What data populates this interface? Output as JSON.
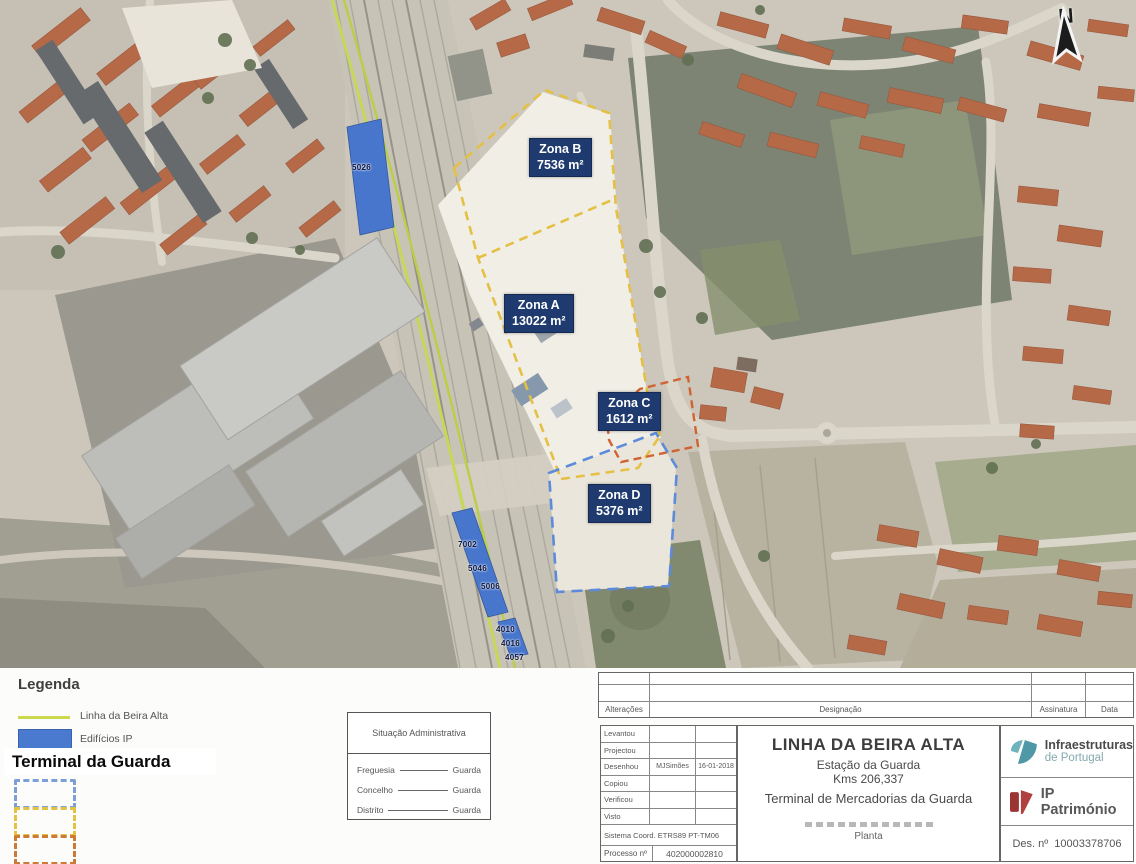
{
  "map": {
    "north_label": "N",
    "zones": [
      {
        "name": "Zona B",
        "area": "7536 m²"
      },
      {
        "name": "Zona A",
        "area": "13022 m²"
      },
      {
        "name": "Zona C",
        "area": "1612 m²"
      },
      {
        "name": "Zona D",
        "area": "5376 m²"
      }
    ],
    "building_labels": [
      "5026",
      "7002",
      "5046",
      "5006",
      "4010",
      "4016",
      "4057"
    ],
    "colors": {
      "zone_label_bg": "#1e3a6e",
      "zones_ab_outline": "#e3bd3a",
      "zone_c_outline": "#cf5a28",
      "zone_d_outline": "#5585d8",
      "beira_alta_line": "#c0d34a",
      "ip_buildings_fill": "#3f6fca"
    }
  },
  "legend": {
    "title": "Legenda",
    "line_item": "Linha da Beira Alta",
    "buildings_item": "Edifícios IP",
    "terminal_title": "Terminal da Guarda"
  },
  "admin_box": {
    "title": "Situação Administrativa",
    "rows": [
      {
        "label": "Freguesia",
        "value": "Guarda"
      },
      {
        "label": "Concelho",
        "value": "Guarda"
      },
      {
        "label": "Distrito",
        "value": "Guarda"
      }
    ]
  },
  "title_block": {
    "revision": {
      "alteracoes": "Alterações",
      "designacao": "Designação",
      "assinatura": "Assinatura",
      "data": "Data"
    },
    "credits": {
      "rows": [
        {
          "label": "Levantou",
          "name": "",
          "date": ""
        },
        {
          "label": "Projectou",
          "name": "",
          "date": ""
        },
        {
          "label": "Desenhou",
          "name": "MJSimões",
          "date": "16-01-2018"
        },
        {
          "label": "Copiou",
          "name": "",
          "date": ""
        },
        {
          "label": "Verificou",
          "name": "",
          "date": ""
        },
        {
          "label": "Visto",
          "name": "",
          "date": ""
        }
      ],
      "sistema_coord": "Sistema Coord. ETRS89 PT-TM06",
      "processo_label": "Processo nº",
      "processo_value": "402000002810"
    },
    "titles": {
      "main": "LINHA DA BEIRA ALTA",
      "sub1": "Estação da Guarda",
      "sub2": "Kms 206,337",
      "sub3": "Terminal de Mercadorias da Guarda",
      "doc_type": "Planta"
    },
    "logos": {
      "infra_line1": "Infraestruturas",
      "infra_line2": "de Portugal",
      "patrimonio": "IP Património"
    },
    "des": {
      "label": "Des. nº",
      "value": "10003378706"
    }
  }
}
